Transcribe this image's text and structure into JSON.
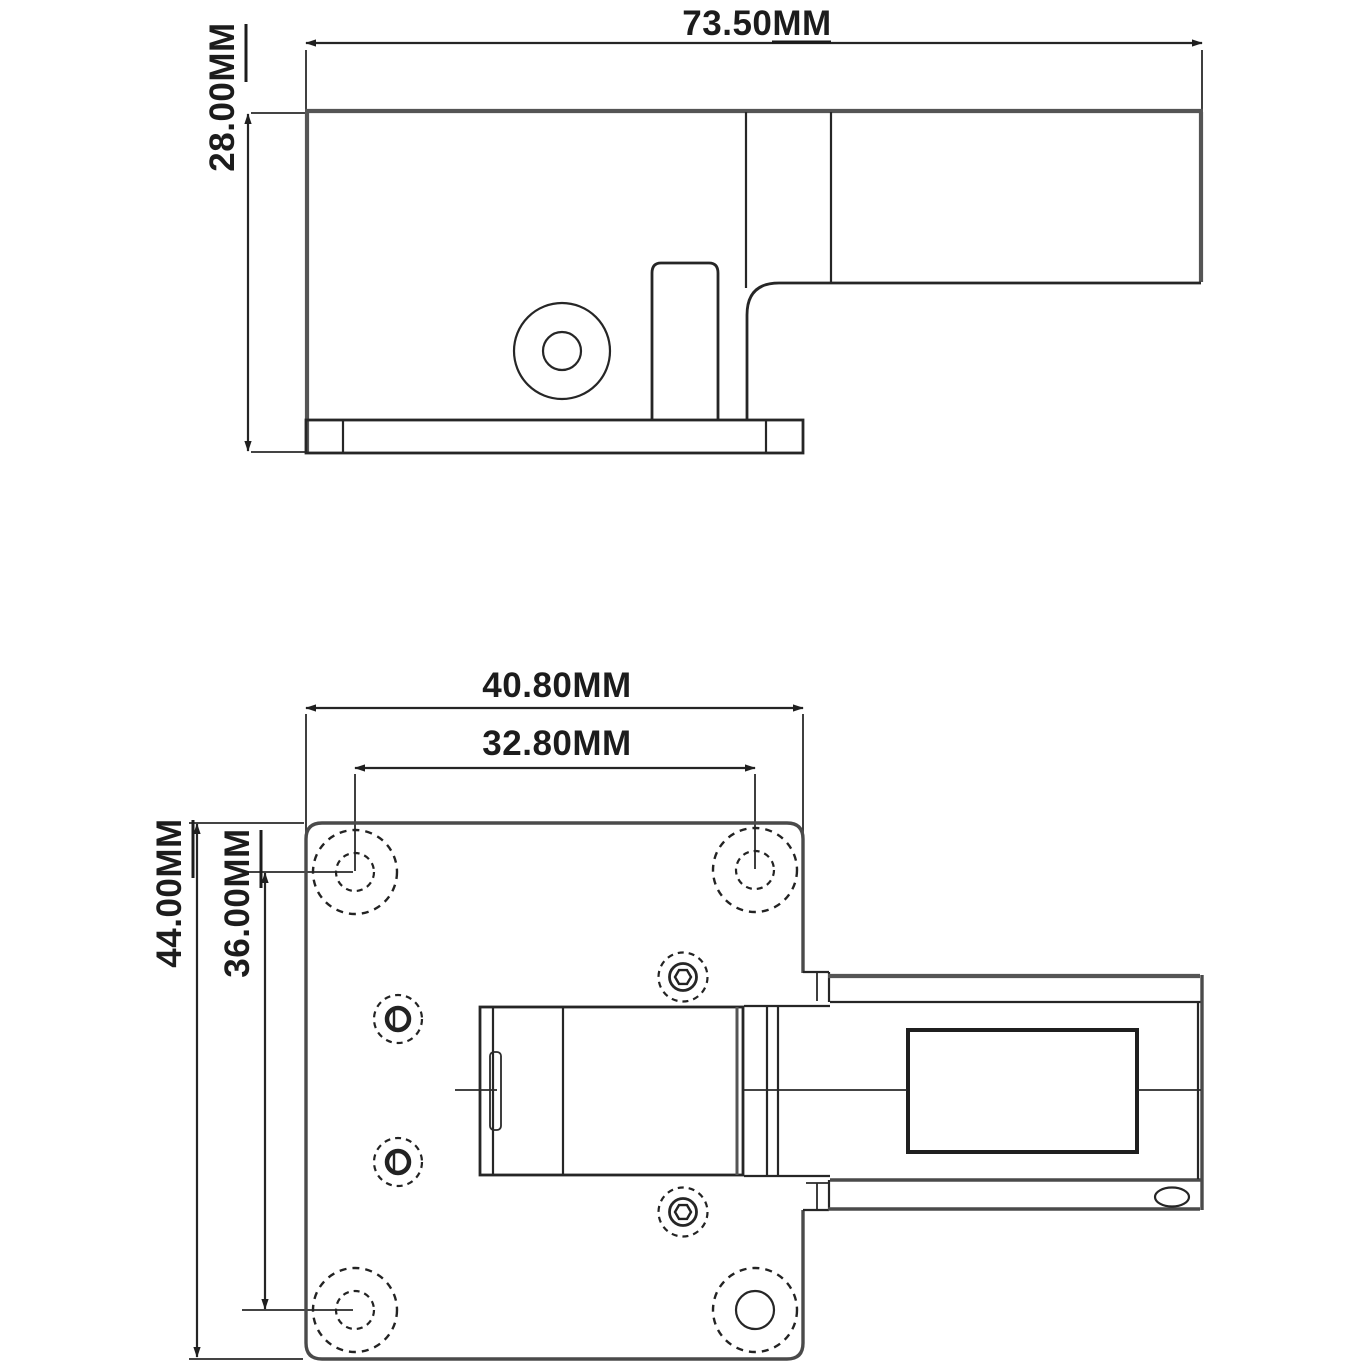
{
  "drawing": {
    "background_color": "#ffffff",
    "line_color": "#262626",
    "heavy_line_color": "#555555",
    "text_color": "#1c1c1c",
    "unit": "MM",
    "dimensions": {
      "side_view": {
        "overall_length": {
          "value": "73.50",
          "unit": "MM",
          "label": "73.50MM"
        },
        "overall_height": {
          "value": "28.00",
          "unit": "MM",
          "label": "28.00MM"
        }
      },
      "plan_view": {
        "plate_width": {
          "value": "40.80",
          "unit": "MM",
          "label": "40.80MM"
        },
        "hole_spacing_x": {
          "value": "32.80",
          "unit": "MM",
          "label": "32.80MM"
        },
        "plate_height": {
          "value": "44.00",
          "unit": "MM",
          "label": "44.00MM"
        },
        "hole_spacing_y": {
          "value": "36.00",
          "unit": "MM",
          "label": "36.00MM"
        }
      }
    }
  }
}
